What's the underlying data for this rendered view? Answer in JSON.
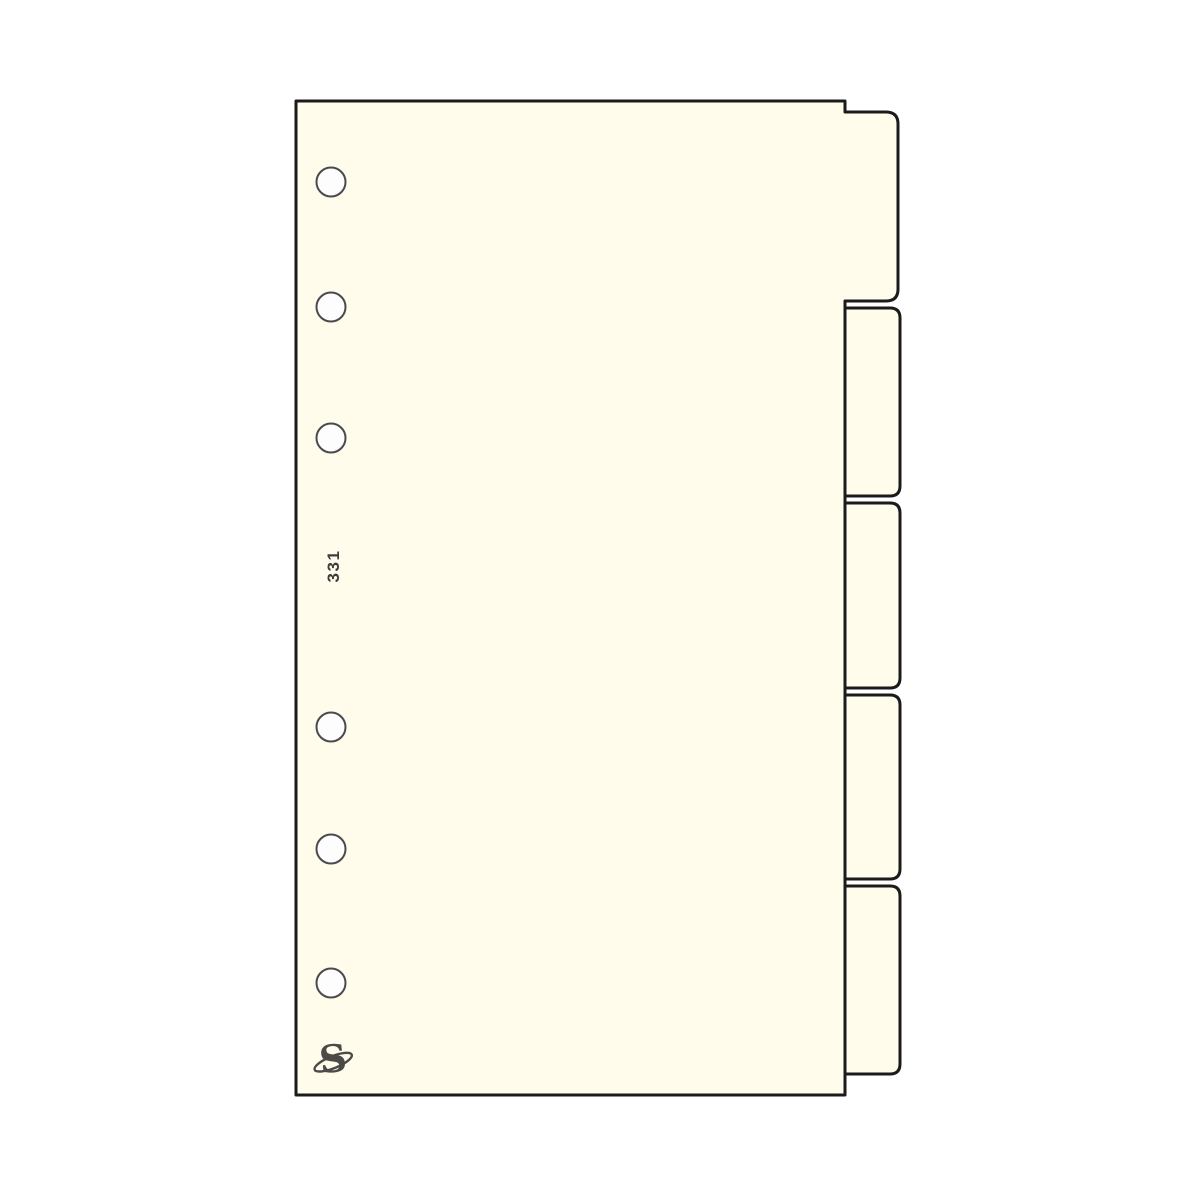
{
  "divider": {
    "page_number": "331",
    "logo_letter": "S",
    "tab_count": 5,
    "hole_count": 6
  },
  "colors": {
    "background": "#FFFFFF",
    "paper": "#FFFCEC",
    "outline": "#1B1B1B",
    "hole_fill": "#FDFDFD",
    "hole_stroke": "#4A4A4C",
    "page_number_color": "#3D3D3D",
    "logo_color": "#4B4A46"
  }
}
